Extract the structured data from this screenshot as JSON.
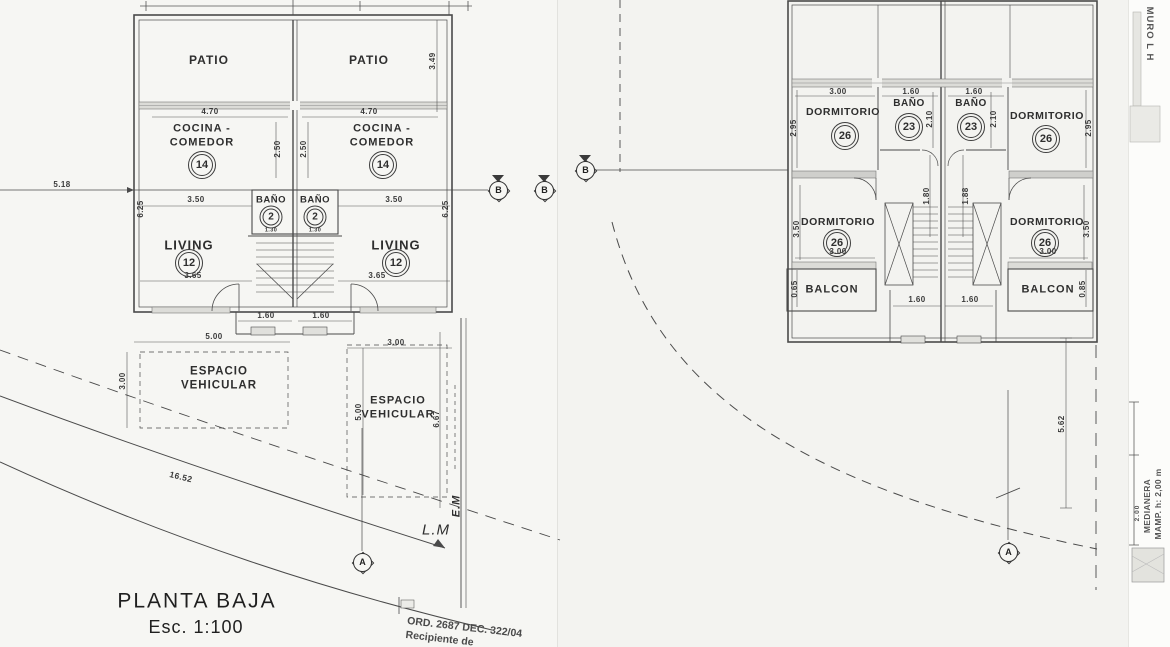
{
  "drawing": {
    "left_plan": {
      "title": "PLANTA BAJA",
      "scale": "Esc. 1:100",
      "rooms": {
        "patio": "PATIO",
        "cocina_line1": "COCINA -",
        "cocina_line2": "COMEDOR",
        "cocina_num": "14",
        "bano": "BAÑO",
        "bano_num": "2",
        "living": "LIVING",
        "living_num": "12",
        "espacio_line1": "ESPACIO",
        "espacio_line2": "VEHICULAR"
      },
      "annotations": {
        "linea_municipal": "L.M",
        "eje_medianero": "E.M",
        "curve_length": "16.52"
      },
      "stamp": {
        "line1": "ORD. 2687 DEC. 322/04",
        "line2": "Recipiente de"
      }
    },
    "right_plan": {
      "rooms": {
        "dormitorio": "DORMITORIO",
        "dormitorio_num": "26",
        "bano": "BAÑO",
        "bano_num": "23",
        "balcon": "BALCON"
      },
      "annotations": {
        "muro": "MURO L H",
        "medianera_line1": "MEDIANERA",
        "medianera_line2": "MAMP. h: 2,00 m",
        "medianera_dim": "2.00"
      }
    },
    "section_markers": {
      "b": "B",
      "a": "A"
    },
    "dimension_labels": [
      {
        "text": "4.70",
        "x": 210,
        "y": 112
      },
      {
        "text": "4.70",
        "x": 369,
        "y": 112
      },
      {
        "text": "2.50",
        "x": 278,
        "y": 149,
        "rot": -90
      },
      {
        "text": "2.50",
        "x": 304,
        "y": 149,
        "rot": -90
      },
      {
        "text": "3.49",
        "x": 433,
        "y": 61,
        "rot": -90
      },
      {
        "text": "5.18",
        "x": 62,
        "y": 185
      },
      {
        "text": "3.50",
        "x": 196,
        "y": 200
      },
      {
        "text": "3.50",
        "x": 394,
        "y": 200
      },
      {
        "text": "6.25",
        "x": 141,
        "y": 209,
        "rot": -90
      },
      {
        "text": "6.25",
        "x": 446,
        "y": 209,
        "rot": -90
      },
      {
        "text": "1.30",
        "x": 271,
        "y": 231,
        "size": 5.5
      },
      {
        "text": "1.30",
        "x": 315,
        "y": 231,
        "size": 5.5
      },
      {
        "text": "3.65",
        "x": 193,
        "y": 276
      },
      {
        "text": "3.65",
        "x": 377,
        "y": 276
      },
      {
        "text": "1.60",
        "x": 266,
        "y": 316
      },
      {
        "text": "1.60",
        "x": 321,
        "y": 316
      },
      {
        "text": "5.00",
        "x": 214,
        "y": 337
      },
      {
        "text": "3.00",
        "x": 396,
        "y": 343
      },
      {
        "text": "3.00",
        "x": 123,
        "y": 381,
        "rot": -90
      },
      {
        "text": "5.00",
        "x": 359,
        "y": 412,
        "rot": -90
      },
      {
        "text": "6.67",
        "x": 437,
        "y": 419,
        "rot": -90
      },
      {
        "text": "16.52",
        "x": 181,
        "y": 477,
        "rot": 14,
        "size": 8.5
      },
      {
        "text": "3.00",
        "x": 838,
        "y": 92
      },
      {
        "text": "1.60",
        "x": 911,
        "y": 92
      },
      {
        "text": "1.60",
        "x": 974,
        "y": 92
      },
      {
        "text": "2.95",
        "x": 794,
        "y": 128,
        "rot": -90
      },
      {
        "text": "2.95",
        "x": 1089,
        "y": 128,
        "rot": -90
      },
      {
        "text": "2.10",
        "x": 930,
        "y": 119,
        "rot": -90
      },
      {
        "text": "2.10",
        "x": 994,
        "y": 119,
        "rot": -90
      },
      {
        "text": "1.80",
        "x": 927,
        "y": 196,
        "rot": -90
      },
      {
        "text": "1.88",
        "x": 966,
        "y": 196,
        "rot": -90
      },
      {
        "text": "3.50",
        "x": 797,
        "y": 229,
        "rot": -90
      },
      {
        "text": "3.50",
        "x": 1087,
        "y": 229,
        "rot": -90
      },
      {
        "text": "3.00",
        "x": 838,
        "y": 252
      },
      {
        "text": "3.00",
        "x": 1048,
        "y": 252
      },
      {
        "text": "0.65",
        "x": 795,
        "y": 289,
        "rot": -90
      },
      {
        "text": "0.85",
        "x": 1083,
        "y": 289,
        "rot": -90
      },
      {
        "text": "1.60",
        "x": 917,
        "y": 300
      },
      {
        "text": "1.60",
        "x": 970,
        "y": 300
      },
      {
        "text": "5.62",
        "x": 1062,
        "y": 424,
        "rot": -90
      }
    ]
  }
}
